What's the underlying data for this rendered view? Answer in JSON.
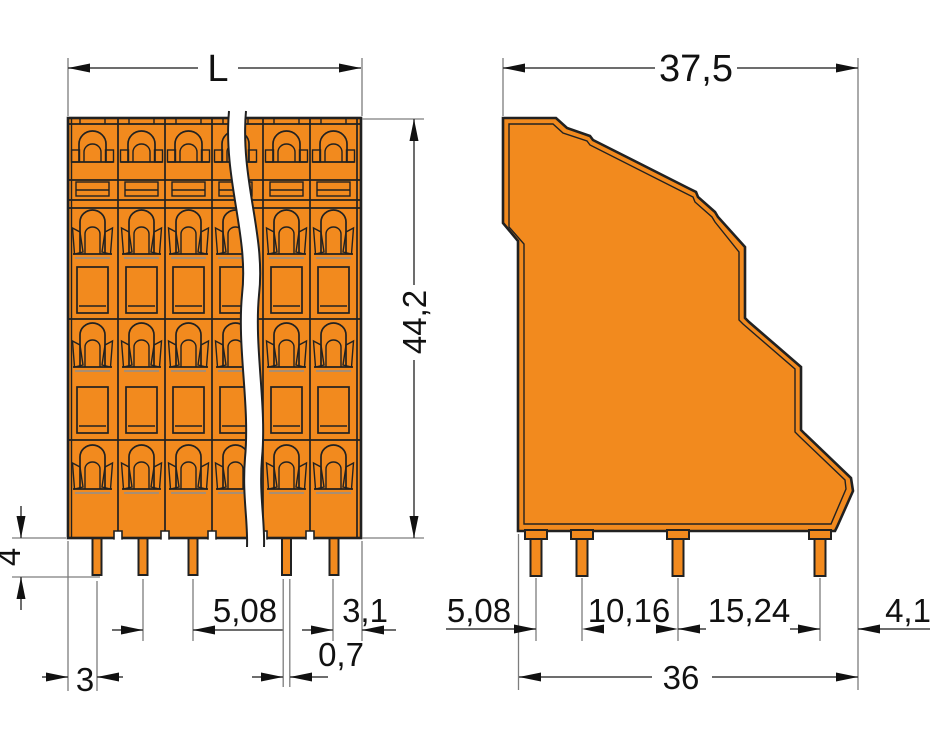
{
  "drawing": {
    "type": "technical-dimension-drawing",
    "subject": "multi-level-pcb-terminal-block",
    "units_style": "decimal-comma-millimeters"
  },
  "views": {
    "front": {
      "name": "front-view",
      "dims": {
        "length": "L",
        "height": "44,2",
        "pin_length": "4",
        "edge_to_first_pin": "3",
        "pin_pitch": "5,08",
        "pin_width": "0,7",
        "last_pin_to_edge": "3,1"
      }
    },
    "side": {
      "name": "side-view",
      "dims": {
        "width": "37,5",
        "pin_row_1_pitch": "5,08",
        "pin_row_2_pitch": "10,16",
        "pin_row_3_pitch": "15,24",
        "last_pin_to_edge": "4,1",
        "bottom_width": "36"
      }
    }
  },
  "colors": {
    "body": "#F28A1E",
    "outline": "#212121",
    "dim_line": "#3d3d3d",
    "ext_line": "#7d7d7d",
    "text": "#111111",
    "background": "#ffffff"
  }
}
